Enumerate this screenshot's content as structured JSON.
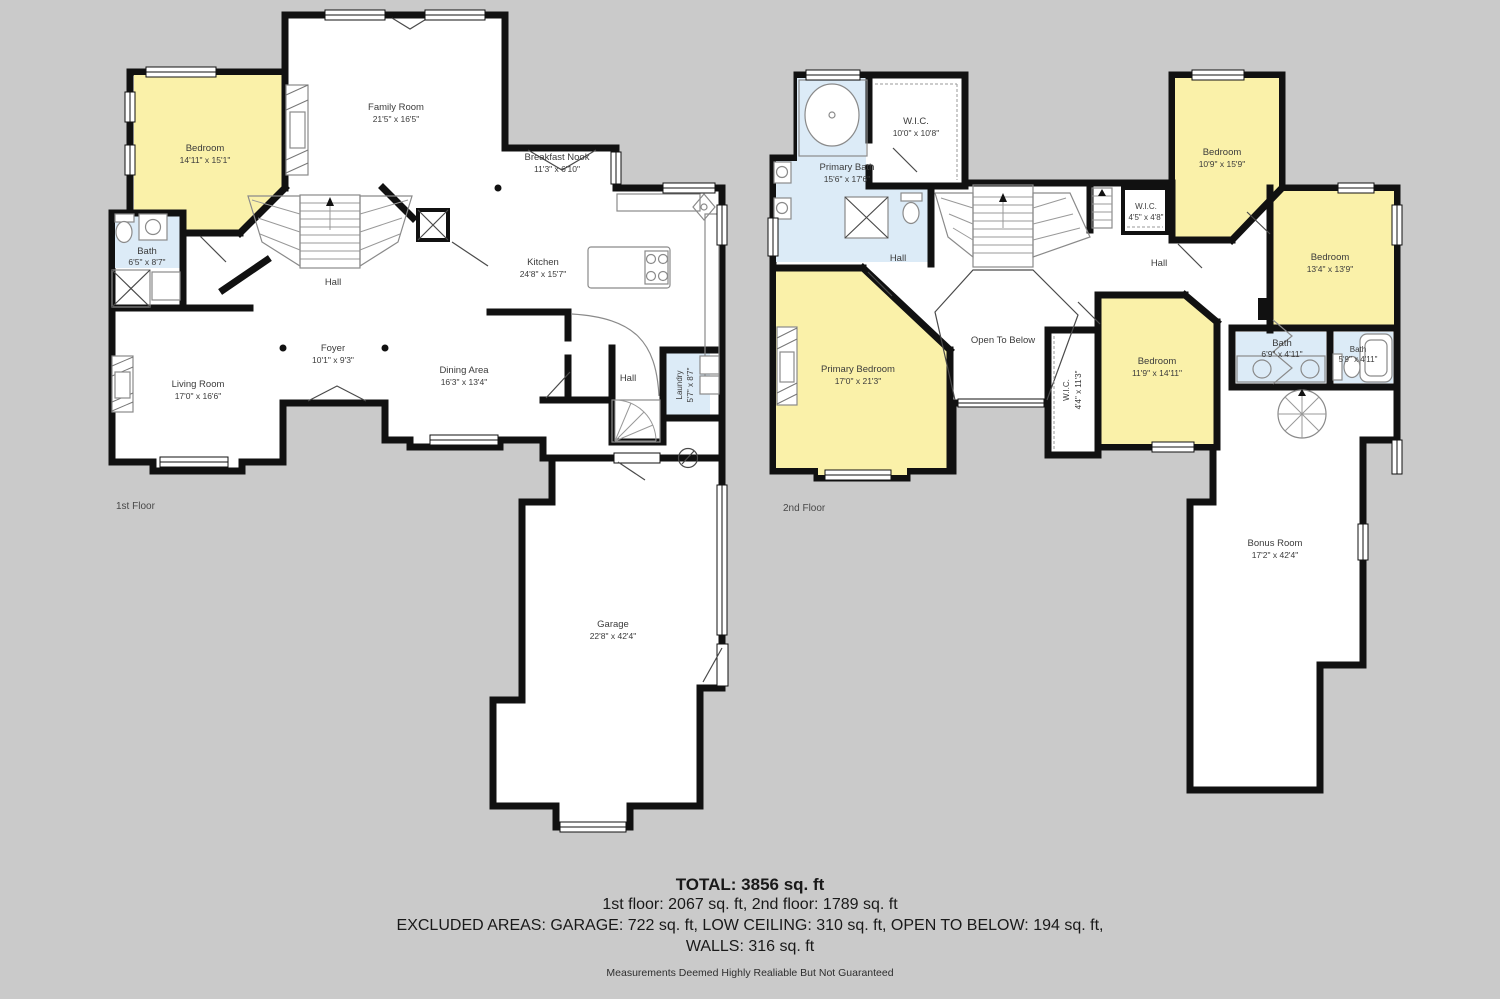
{
  "background": "#cacaca",
  "colors": {
    "wall": "#111111",
    "room_fill": "#ffffff",
    "bedroom_fill": "#faf1a9",
    "bath_fill": "#dcebf7",
    "furniture": "#8a8a8a",
    "text": "#3b3b3b"
  },
  "floor1": {
    "floor_label": "1st Floor",
    "rooms": {
      "bedroom": {
        "name": "Bedroom",
        "dims": "14'11\" x 15'1\""
      },
      "bath": {
        "name": "Bath",
        "dims": "6'5\" x 8'7\""
      },
      "family_room": {
        "name": "Family Room",
        "dims": "21'5\" x 16'5\""
      },
      "breakfast_nook": {
        "name": "Breakfast Nook",
        "dims": "11'3\" x 6'10\""
      },
      "kitchen": {
        "name": "Kitchen",
        "dims": "24'8\" x 15'7\""
      },
      "hall": {
        "name": "Hall"
      },
      "foyer": {
        "name": "Foyer",
        "dims": "10'1\" x 9'3\""
      },
      "living_room": {
        "name": "Living Room",
        "dims": "17'0\" x 16'6\""
      },
      "dining_area": {
        "name": "Dining Area",
        "dims": "16'3\" x 13'4\""
      },
      "hall_rear": {
        "name": "Hall"
      },
      "laundry": {
        "name": "Laundry",
        "dims": "5'7\" x 8'7\""
      },
      "garage": {
        "name": "Garage",
        "dims": "22'8\" x 42'4\""
      }
    }
  },
  "floor2": {
    "floor_label": "2nd Floor",
    "rooms": {
      "primary_bath": {
        "name": "Primary Bath",
        "dims": "15'6\" x 17'6\""
      },
      "wic_primary": {
        "name": "W.I.C.",
        "dims": "10'0\" x 10'8\""
      },
      "hall_left": {
        "name": "Hall"
      },
      "bedroom_top": {
        "name": "Bedroom",
        "dims": "10'9\" x 15'9\""
      },
      "wic_hall": {
        "name": "W.I.C.",
        "dims": "4'5\" x 4'8\""
      },
      "hall_right": {
        "name": "Hall"
      },
      "bedroom_right": {
        "name": "Bedroom",
        "dims": "13'4\" x 13'9\""
      },
      "primary_bedroom": {
        "name": "Primary Bedroom",
        "dims": "17'0\" x 21'3\""
      },
      "open_to_below": {
        "name": "Open To Below"
      },
      "wic_bedroom": {
        "name": "W.I.C.",
        "dims": "4'4\" x 11'3\""
      },
      "bedroom_center": {
        "name": "Bedroom",
        "dims": "11'9\" x 14'11\""
      },
      "bath_double": {
        "name": "Bath",
        "dims": "6'9\" x 4'11\""
      },
      "bath_single": {
        "name": "Bath",
        "dims": "5'9\" x 4'11\""
      },
      "bonus_room": {
        "name": "Bonus Room",
        "dims": "17'2\" x 42'4\""
      }
    }
  },
  "summary": {
    "total": "TOTAL: 3856 sq. ft",
    "floors": "1st floor: 2067 sq. ft, 2nd floor: 1789 sq. ft",
    "excluded": "EXCLUDED AREAS: GARAGE: 722 sq. ft, LOW CEILING: 310 sq. ft, OPEN TO BELOW: 194 sq. ft,",
    "walls": "WALLS: 316 sq. ft",
    "disclaimer": "Measurements Deemed Highly Realiable But Not Guaranteed"
  }
}
